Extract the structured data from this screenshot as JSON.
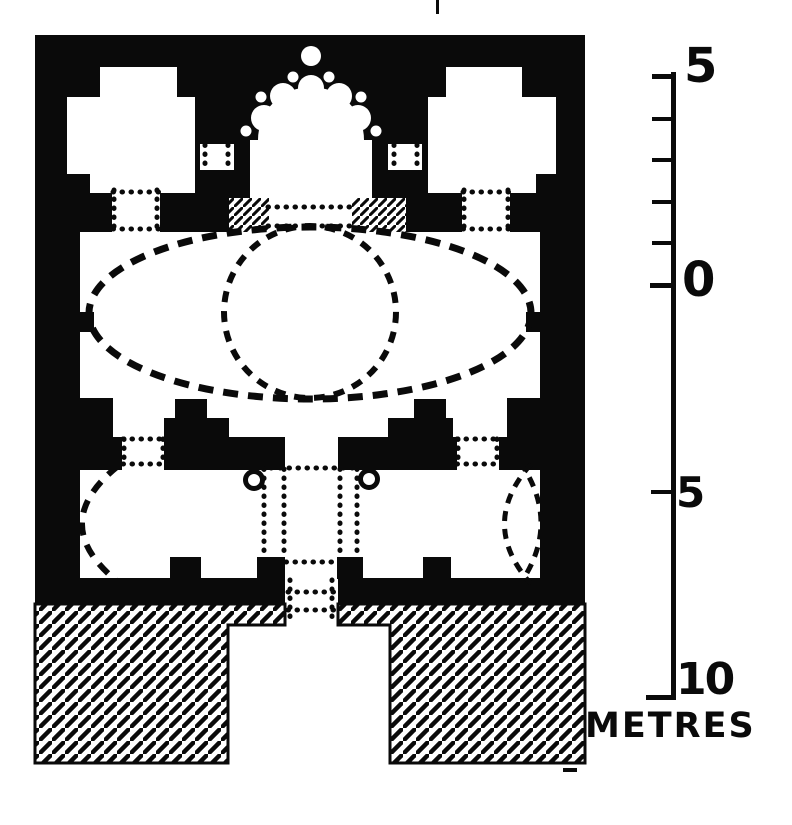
{
  "figure": {
    "description": "Scanned black-ink architectural floor plan: rectangular building with two cross-shaped corner rooms, a semicircular colonnaded exedra with scalloped niches at top, dotted oval and circle outlines of the vaulted central hall, lower rooms with dotted apse and circle outlines, a central dotted passage with two columns, and a diagonally hatched podium with a central stair recess; metre scale bar at right",
    "ink_color": "#0a0a0a",
    "paper_color": "#ffffff",
    "hatch_style": "diagonal-lines"
  },
  "scale_bar": {
    "labels": [
      {
        "text": "5"
      },
      {
        "text": "0"
      },
      {
        "text": "5"
      },
      {
        "text": "10"
      }
    ],
    "unit": "METRES",
    "upper_segment_metres": 5,
    "upper_tick_interval_metres": 1,
    "lower_segment_metres": 10,
    "lower_tick_interval_metres": 5
  }
}
